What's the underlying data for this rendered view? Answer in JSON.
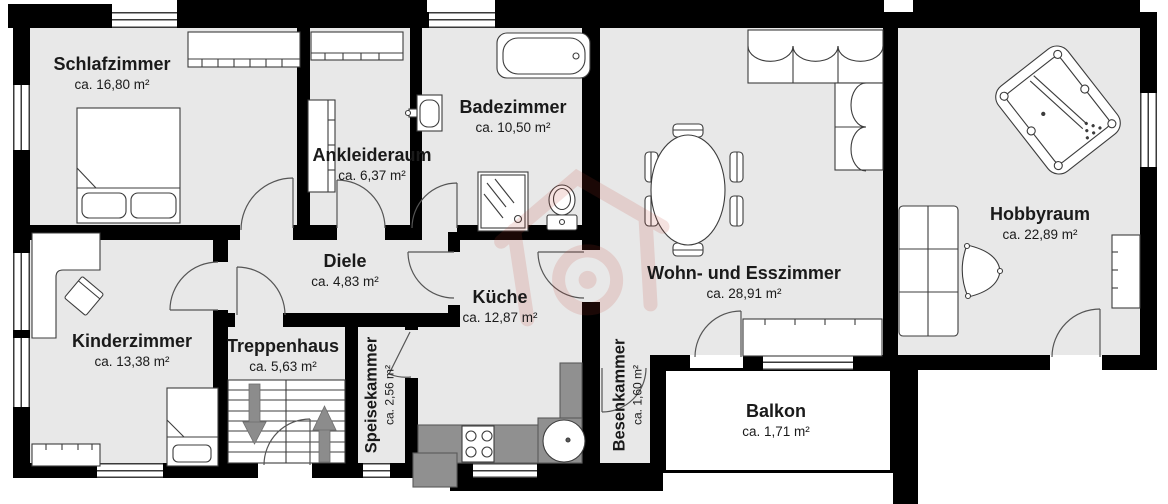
{
  "plan_title": "Wohnungsgrundriss",
  "colors": {
    "wall": "#000000",
    "floor": "#e8e8e8",
    "counter": "#8f8f8f",
    "watermark": "#c0392b"
  },
  "rooms": {
    "schlafzimmer": {
      "name": "Schlafzimmer",
      "area": "ca. 16,80 m²"
    },
    "ankleideraum": {
      "name": "Ankleideraum",
      "area": "ca. 6,37 m²"
    },
    "badezimmer": {
      "name": "Badezimmer",
      "area": "ca. 10,50 m²"
    },
    "diele": {
      "name": "Diele",
      "area": "ca. 4,83 m²"
    },
    "kinderzimmer": {
      "name": "Kinderzimmer",
      "area": "ca. 13,38 m²"
    },
    "treppenhaus": {
      "name": "Treppenhaus",
      "area": "ca. 5,63 m²"
    },
    "speisekammer": {
      "name": "Speisekammer",
      "area": "ca. 2,56 m²"
    },
    "kueche": {
      "name": "Küche",
      "area": "ca. 12,87 m²"
    },
    "wohn_esszimmer": {
      "name": "Wohn- und Esszimmer",
      "area": "ca. 28,91 m²"
    },
    "besenkammer": {
      "name": "Besenkammer",
      "area": "ca. 1,60 m²"
    },
    "balkon": {
      "name": "Balkon",
      "area": "ca. 1,71 m²"
    },
    "hobbyraum": {
      "name": "Hobbyraum",
      "area": "ca. 22,89 m²"
    }
  },
  "icons": {
    "bed": "bed-icon",
    "wardrobe": "wardrobe-icon",
    "bathtub": "bathtub-icon",
    "shower": "shower-icon",
    "toilet": "toilet-icon",
    "washbasin": "washbasin-icon",
    "dining_table": "dining-table-icon",
    "sofa": "sofa-icon",
    "stairs": "stairs-icon",
    "billiard": "billiard-table-icon",
    "stove": "stove-icon",
    "kitchen_sink": "kitchen-sink-icon"
  }
}
